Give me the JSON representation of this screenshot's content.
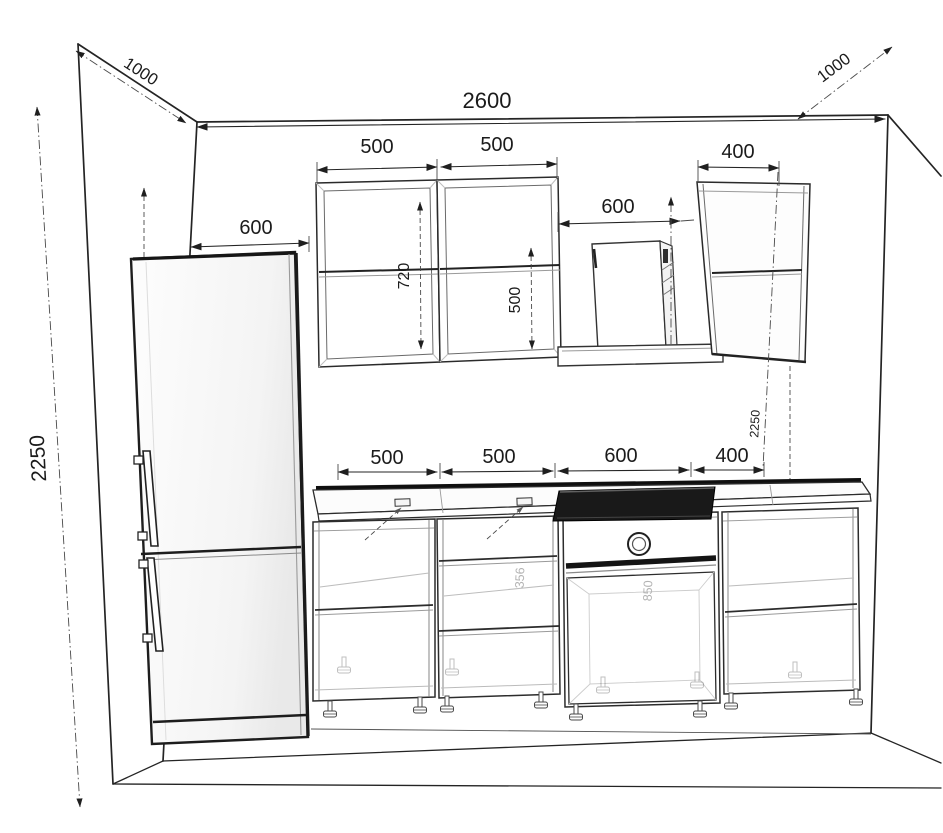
{
  "diagram": {
    "kind": "kitchen-elevation-drawing",
    "room": {
      "width": "2600",
      "height": "2250",
      "height_right": "2250",
      "depth_left": "1000",
      "depth_right": "1000"
    },
    "fridge": {
      "width": "600"
    },
    "wall_row": {
      "cabinet1_width": "500",
      "cabinet2_width": "500",
      "hood_clearance": "600",
      "cabinet3_width": "400",
      "cabinet1_height": "720",
      "cabinet2_door_height": "500"
    },
    "base_row": {
      "cabinet1_width": "500",
      "cabinet2_width": "500",
      "oven_cabinet_width": "600",
      "cabinet4_width": "400",
      "cabinet2_inner_height": "356",
      "oven_inner_height": "850"
    },
    "colors": {
      "ink": "#1f1f1f",
      "faint": "#b5b5b5",
      "background": "#ffffff"
    }
  }
}
